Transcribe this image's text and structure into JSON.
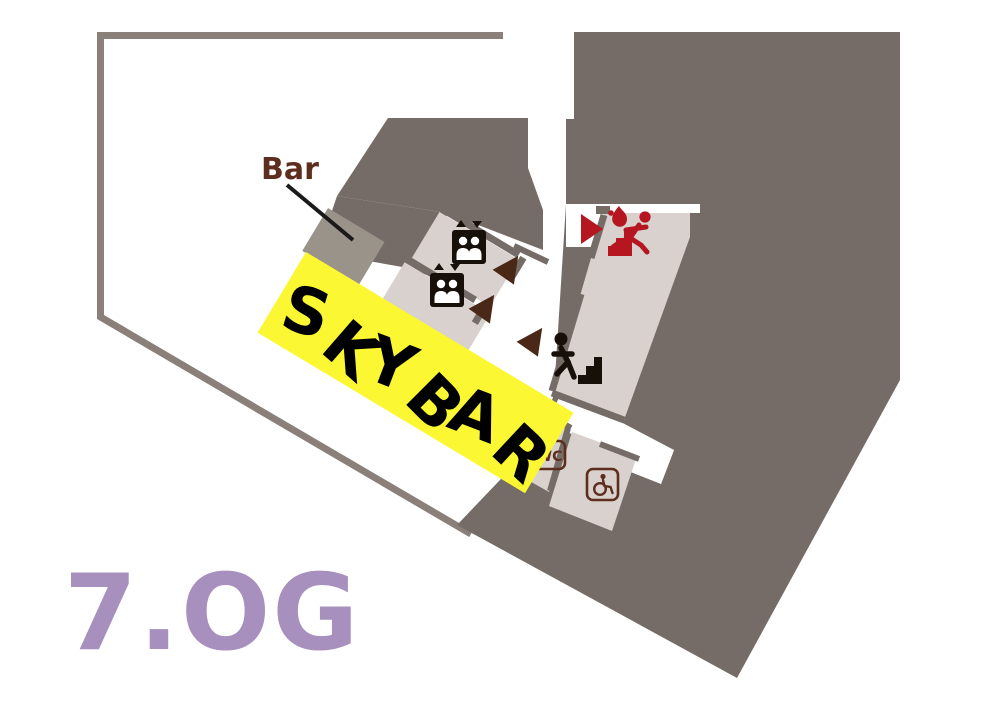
{
  "floor_plan": {
    "floor_title": "7.OG",
    "labels": {
      "bar": "Bar",
      "skybar": "SKYBAR",
      "wc": "WC"
    },
    "rooms": [
      "Skybar area",
      "Bar counter",
      "Elevator room 1",
      "Elevator room 2",
      "Emergency stairwell",
      "Stairs down",
      "WC",
      "Accessible WC"
    ],
    "icons": {
      "elevator": "elevator-two-persons-with-up-down-arrows",
      "stairs_down": "person-descending-stairs",
      "emergency_exit": "running-person-with-flame-on-stairs",
      "accessible_wc": "wheelchair-symbol",
      "route_arrow": "triangle-arrowhead",
      "exit_arrow": "red-triangle-arrowhead"
    },
    "route_arrows": {
      "brown_arrow_count": 3,
      "red_arrow_count": 1
    },
    "colors": {
      "building_mass": "#756c67",
      "floor_outline": "#8a8079",
      "room_fill": "#d8d1cd",
      "bar_counter": "#9a9389",
      "skybar_banner": "#fbf733",
      "skybar_text": "#000000",
      "floor_title": "#a78fbe",
      "escape_red": "#b5161f",
      "route_arrow_brown": "#4a2817",
      "symbol_brown": "#5d2e1d",
      "icon_black": "#161008",
      "leader_line": "#1a1a1a"
    }
  }
}
